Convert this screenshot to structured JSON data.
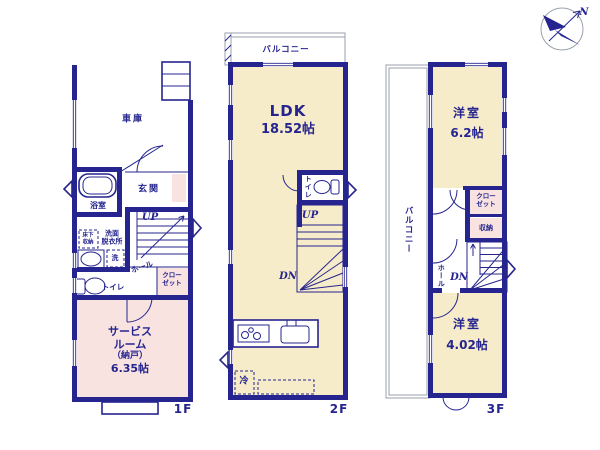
{
  "colors": {
    "wall": "#26258f",
    "room_cream": "#f7ecca",
    "room_pink": "#f8e3e1",
    "outline_gray": "#9aa2ac"
  },
  "compass": {
    "north": "N"
  },
  "floor1": {
    "label": "1F",
    "garage": "車庫",
    "entrance": "玄関",
    "bath": "浴室",
    "washroom": [
      "洗面",
      "脱衣所"
    ],
    "underfloor": [
      "床下",
      "収納"
    ],
    "washer": "洗",
    "toilet": "トイレ",
    "hall": "ホール",
    "up": "UP",
    "closet": [
      "クロー",
      "ゼット"
    ],
    "service_room": [
      "サービス",
      "ルーム",
      "（納戸）",
      "6.35帖"
    ]
  },
  "floor2": {
    "label": "2F",
    "balcony": "バルコニー",
    "ldk": "LDK",
    "ldk_size": "18.52帖",
    "toilet": "トイレ",
    "up": "UP",
    "dn": "DN",
    "fridge": "冷"
  },
  "floor3": {
    "label": "3F",
    "balcony": "バルコニー",
    "room_upper": "洋室",
    "room_upper_size": "6.2帖",
    "closet": [
      "クロー",
      "ゼット"
    ],
    "storage": "収納",
    "hall": "ホール",
    "dn": "DN",
    "room_lower": "洋室",
    "room_lower_size": "4.02帖"
  }
}
